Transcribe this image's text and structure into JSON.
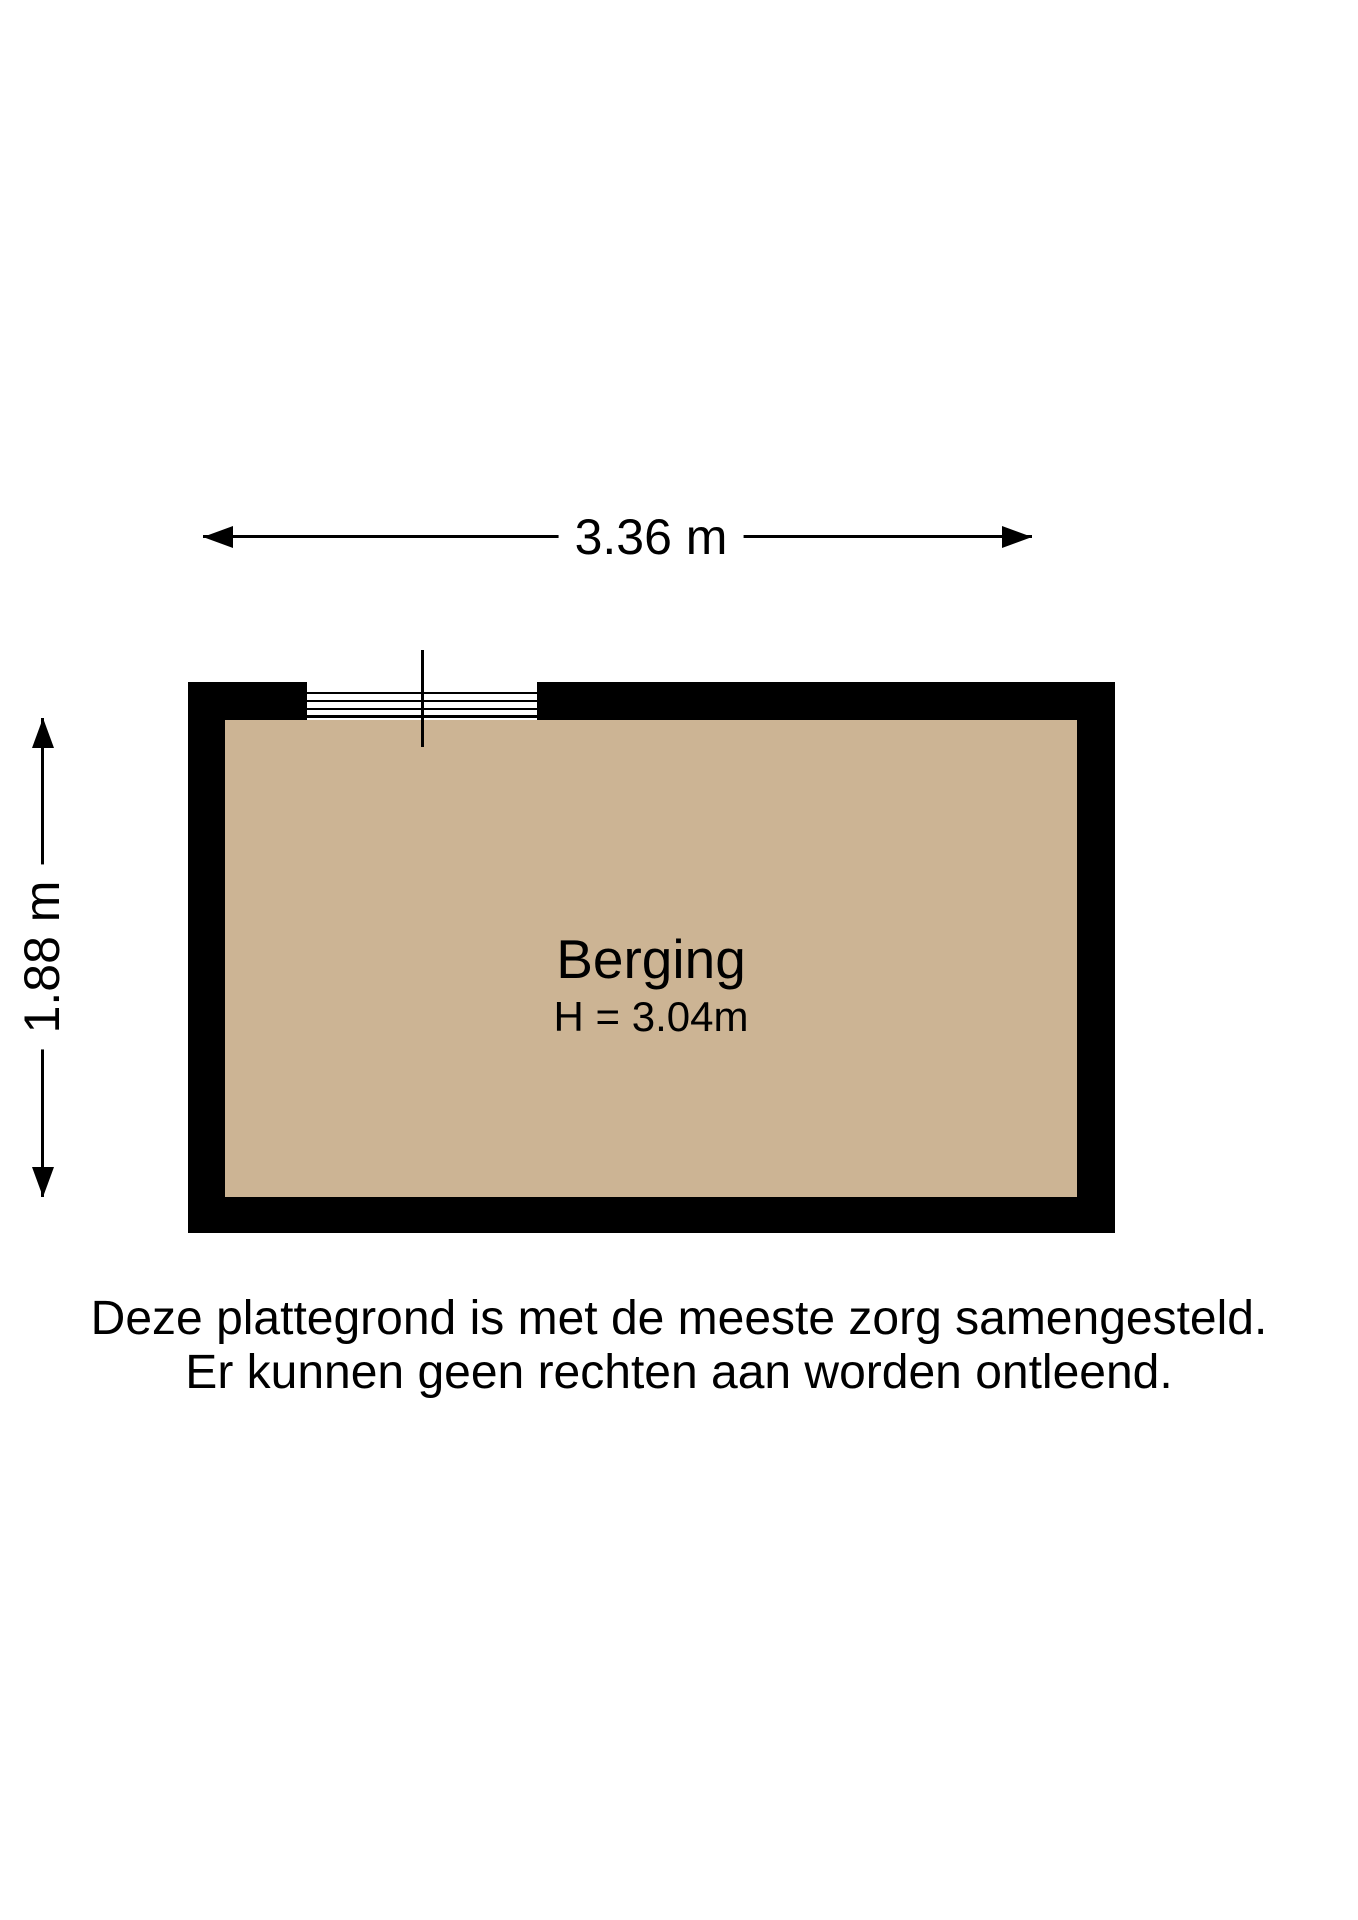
{
  "colors": {
    "background": "#ffffff",
    "wall": "#000000",
    "floor": "#ccb494",
    "line": "#000000",
    "text": "#000000"
  },
  "dimensions": {
    "width_label": "3.36 m",
    "height_label": "1.88 m"
  },
  "room": {
    "name": "Berging",
    "ceiling_height_label": "H = 3.04m"
  },
  "disclaimer": {
    "line1": "Deze plattegrond is met de meeste zorg samengesteld.",
    "line2": "Er kunnen geen rechten aan worden ontleend."
  }
}
